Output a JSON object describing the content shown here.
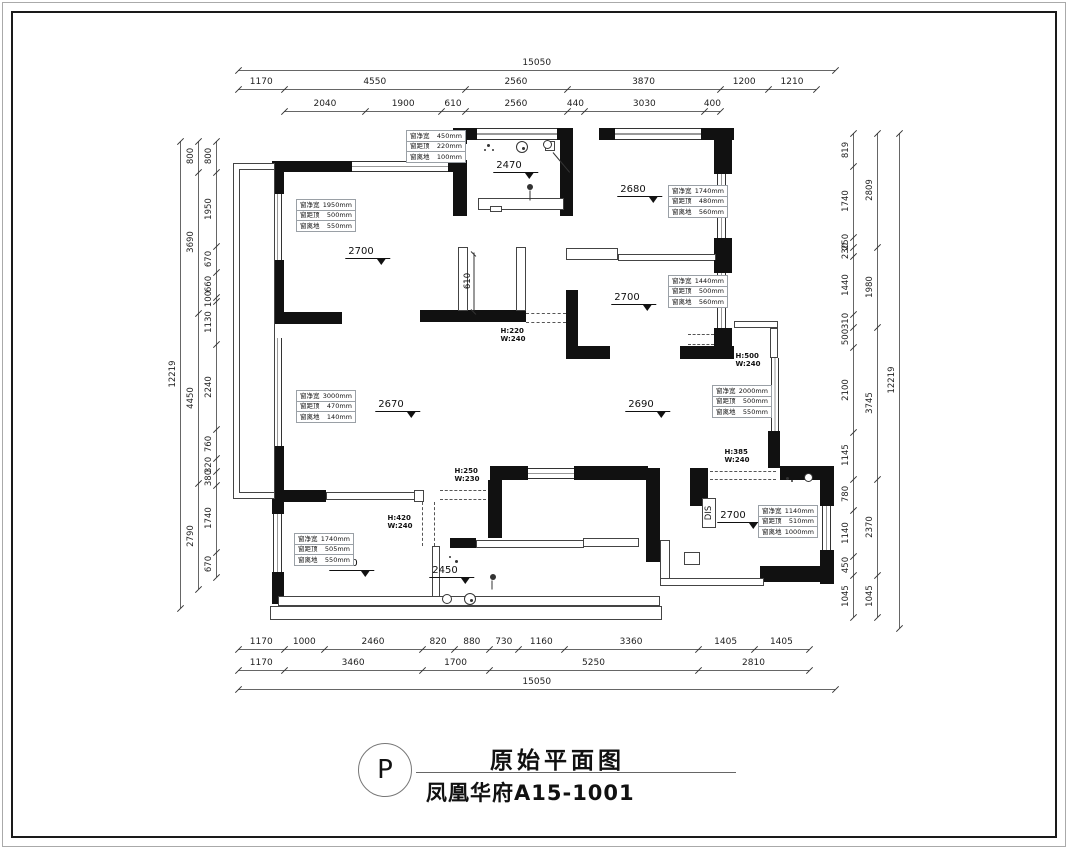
{
  "title_block": {
    "badge": "P",
    "title": "原始平面图",
    "subtitle": "凤凰华府A15-1001"
  },
  "dimensions": {
    "horizontal": {
      "x0": 238,
      "scale": 0.0397,
      "chains": [
        {
          "y": 70,
          "off": 0,
          "segments": [
            15050
          ]
        },
        {
          "y": 89,
          "off": 0,
          "segments": [
            1170,
            4550,
            2560,
            3870,
            1200,
            1210
          ]
        },
        {
          "y": 111,
          "off": 1170,
          "segments": [
            2040,
            1900,
            610,
            2560,
            440,
            3030,
            400
          ]
        },
        {
          "y": 649,
          "off": 0,
          "segments": [
            1170,
            1000,
            2460,
            820,
            880,
            730,
            1160,
            3360,
            1405,
            1405
          ]
        },
        {
          "y": 670,
          "off": 0,
          "segments": [
            1170,
            3460,
            1700,
            5250,
            2810
          ]
        },
        {
          "y": 689,
          "off": 0,
          "segments": [
            15050
          ]
        }
      ]
    },
    "vertical_left": {
      "y0": 141,
      "scale": 0.0382,
      "chains": [
        {
          "x": 180,
          "off": 0,
          "segments": [
            12219
          ]
        },
        {
          "x": 198,
          "off": 0,
          "segments": [
            800,
            3690,
            4450,
            2790
          ]
        },
        {
          "x": 216,
          "off": 0,
          "segments": [
            800,
            1950,
            670,
            660,
            100,
            1130,
            2240,
            760,
            320,
            380,
            1740,
            670
          ]
        }
      ]
    },
    "vertical_right": {
      "y0": 133,
      "scale": 0.0405,
      "chains": [
        {
          "x": 853,
          "off": 0,
          "segments": [
            819,
            1740,
            250,
            230,
            1440,
            310,
            500,
            2100,
            1145,
            780,
            1140,
            450,
            1045
          ]
        },
        {
          "x": 877,
          "off": 0,
          "segments": [
            2809,
            1980,
            3745,
            2370,
            1045
          ]
        },
        {
          "x": 899,
          "off": 0,
          "segments": [
            12219
          ]
        }
      ]
    }
  },
  "levels": [
    {
      "value": "2470",
      "x": 516,
      "y": 160
    },
    {
      "value": "2700",
      "x": 368,
      "y": 246
    },
    {
      "value": "2680",
      "x": 640,
      "y": 184
    },
    {
      "value": "2700",
      "x": 634,
      "y": 292
    },
    {
      "value": "2670",
      "x": 398,
      "y": 399
    },
    {
      "value": "2690",
      "x": 648,
      "y": 399
    },
    {
      "value": "2700",
      "x": 352,
      "y": 558
    },
    {
      "value": "2450",
      "x": 452,
      "y": 565
    },
    {
      "value": "2700",
      "x": 740,
      "y": 510
    }
  ],
  "window_annotations": [
    {
      "x": 406,
      "y": 131,
      "rows": [
        [
          "窗净宽",
          "450mm"
        ],
        [
          "窗距顶",
          "220mm"
        ],
        [
          "窗离地",
          "100mm"
        ]
      ]
    },
    {
      "x": 296,
      "y": 200,
      "rows": [
        [
          "窗净宽",
          "1950mm"
        ],
        [
          "窗距顶",
          "500mm"
        ],
        [
          "窗离地",
          "550mm"
        ]
      ]
    },
    {
      "x": 668,
      "y": 186,
      "rows": [
        [
          "窗净宽",
          "1740mm"
        ],
        [
          "窗距顶",
          "480mm"
        ],
        [
          "窗离地",
          "560mm"
        ]
      ]
    },
    {
      "x": 668,
      "y": 276,
      "rows": [
        [
          "窗净宽",
          "1440mm"
        ],
        [
          "窗距顶",
          "500mm"
        ],
        [
          "窗离地",
          "560mm"
        ]
      ]
    },
    {
      "x": 296,
      "y": 391,
      "rows": [
        [
          "窗净宽",
          "3000mm"
        ],
        [
          "窗距顶",
          "470mm"
        ],
        [
          "窗离地",
          "140mm"
        ]
      ]
    },
    {
      "x": 712,
      "y": 386,
      "rows": [
        [
          "窗净宽",
          "2000mm"
        ],
        [
          "窗距顶",
          "500mm"
        ],
        [
          "窗离地",
          "550mm"
        ]
      ]
    },
    {
      "x": 294,
      "y": 534,
      "rows": [
        [
          "窗净宽",
          "1740mm"
        ],
        [
          "窗距顶",
          "505mm"
        ],
        [
          "窗离地",
          "550mm"
        ]
      ]
    },
    {
      "x": 758,
      "y": 506,
      "rows": [
        [
          "窗净宽",
          "1140mm"
        ],
        [
          "窗距顶",
          "510mm"
        ],
        [
          "窗离地",
          "1000mm"
        ]
      ]
    }
  ],
  "opening_labels": [
    {
      "x": 513,
      "y": 327,
      "lines": [
        "H:220",
        "W:240"
      ]
    },
    {
      "x": 748,
      "y": 352,
      "lines": [
        "H:500",
        "W:240"
      ]
    },
    {
      "x": 737,
      "y": 448,
      "lines": [
        "H:385",
        "W:240"
      ]
    },
    {
      "x": 467,
      "y": 467,
      "lines": [
        "H:250",
        "W:230"
      ]
    },
    {
      "x": 400,
      "y": 514,
      "lines": [
        "H:420",
        "W:240"
      ]
    }
  ],
  "misc_labels": [
    {
      "text": "610",
      "x": 468,
      "y": 281
    },
    {
      "text": "DIS",
      "x": 709,
      "y": 513
    }
  ]
}
